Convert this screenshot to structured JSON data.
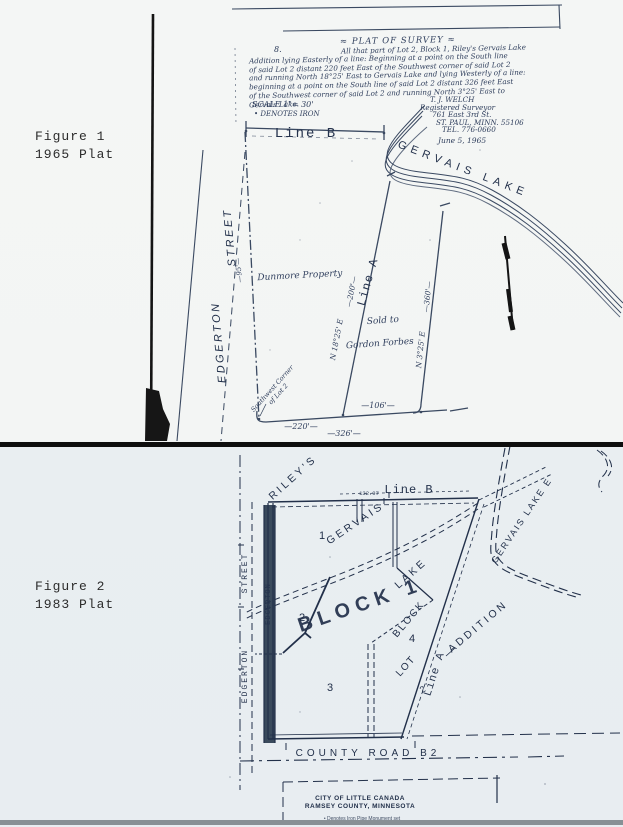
{
  "figure1": {
    "caption": {
      "line1": "Figure 1",
      "line2": "1965 Plat"
    },
    "survey": {
      "ref": "8.",
      "title": "≈ PLAT OF SURVEY ≈",
      "desc": [
        "All that part of Lot 2, Block 1, Riley's Gervais Lake",
        "Addition lying Easterly of a line: Beginning at a point on the South line",
        "of said Lot 2 distant 220 feet East of the Southwest corner of said Lot 2",
        "and running North 18°25' East to Gervais Lake and lying Westerly of a line:",
        "beginning at a point on the South line of said Lot 2 distant 326 feet East",
        "of the Southwest corner of said Lot 2 and running North 3°25' East to",
        "Gervais Lake."
      ],
      "scale": "SCALE 1\"= 30'",
      "legend": "• DENOTES IRON",
      "surveyor": [
        "T. J. WELCH",
        "Registered Surveyor",
        "761 East 3rd St.",
        "ST. PAUL, MINN. 55106",
        "TEL. 776-0660"
      ],
      "date": "June 5, 1965"
    },
    "plat": {
      "line_b": "Line B",
      "line_a": "Line A",
      "lake": "GERVAIS  LAKE",
      "street_word1": "EDGERTON",
      "street_word2": "STREET",
      "property": "Dunmore Property",
      "sold_line1": "Sold to",
      "sold_line2": "Gordon Forbes",
      "bearing_a": "N 18°25' E",
      "bearing_e": "N 3°25' E",
      "dim_line_a": "—200'—",
      "dim_line_e": "—360'—",
      "dim_base_left": "—220'—",
      "dim_base_total": "—326'—",
      "dim_base_right": "—106'—",
      "dim_west": "—95'—",
      "sw_corner_line1": "Southwest Corner",
      "sw_corner_line2": "of Lot 2"
    }
  },
  "figure2": {
    "caption": {
      "line1": "Figure 2",
      "line2": "1983 Plat"
    },
    "plat": {
      "rileys": "RILEY'S",
      "gervais": "GERVAIS",
      "lake": "LAKE",
      "addition": "ADDITION",
      "line_b": "Line B",
      "line_b_dim": "132.97",
      "block1": "BLOCK 1",
      "block": "BLOCK",
      "lot": "LOT",
      "lot_sub": "2",
      "line_a": "Line A",
      "lot_numbers": {
        "n1": "1",
        "n2": "2",
        "n3": "3",
        "n4": "4"
      },
      "street_word1": "EDGERTON",
      "street_word2": "STREET",
      "road_strip_label": "EDGERTON",
      "lake_east": "GERVAIS  LAKE E",
      "county_road": "COUNTY  ROAD  B2",
      "city_line1": "CITY OF LITTLE CANADA",
      "city_line2": "RAMSEY COUNTY, MINNESOTA",
      "note": "• Denotes Iron Pipe Monument set"
    }
  },
  "colors": {
    "ink": "#31405e",
    "ink_dark": "#22304a",
    "artifact_black": "#141414",
    "paper_top": "#f4f6f5",
    "paper_bottom": "#e9eef1"
  }
}
